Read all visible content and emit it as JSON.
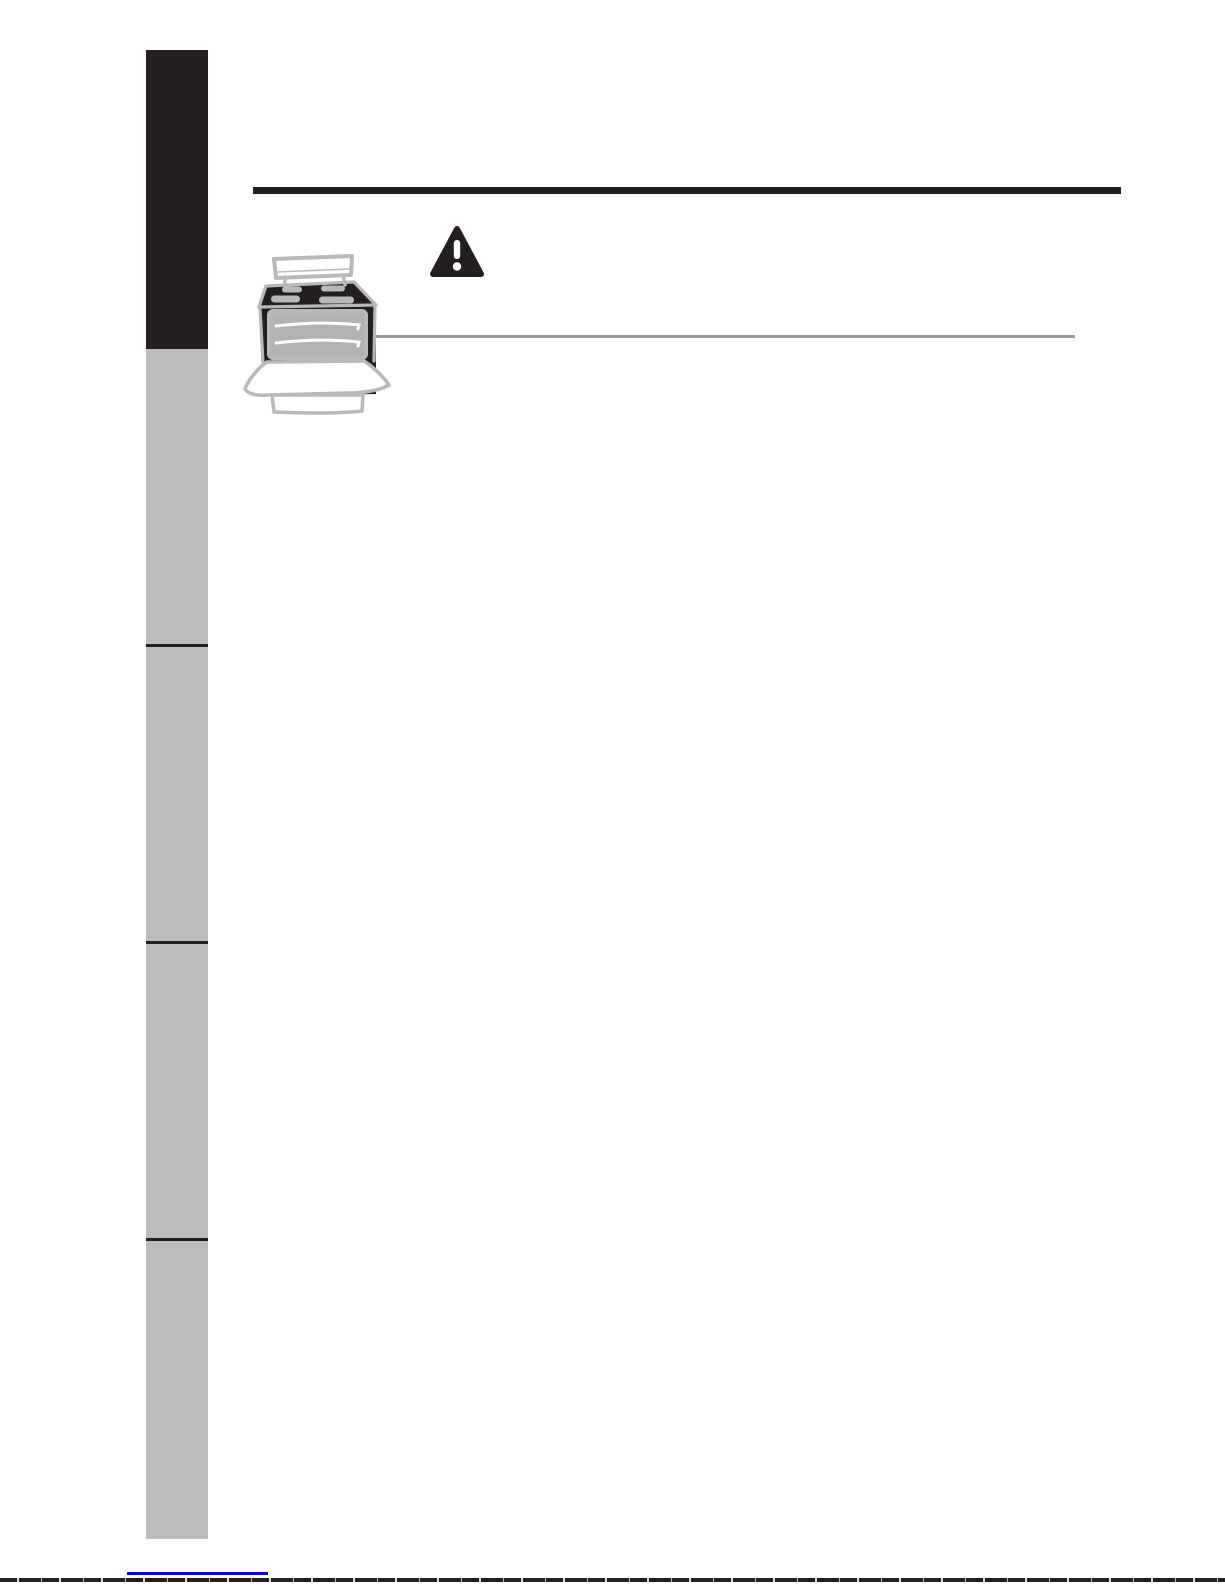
{
  "page": {
    "background": "#ffffff"
  },
  "colors": {
    "ink": "#231f20",
    "tab_gray": "#bcbcbc",
    "sketch_gray": "#b9b9b9",
    "cavity_gray": "#b3b3b3",
    "hairline_gray": "#9a9a9c",
    "link_blue": "#0600d8"
  },
  "sidebar": {
    "segments": [
      {
        "tone": "dark"
      },
      {
        "tone": "gray"
      },
      {
        "tone": "gray"
      },
      {
        "tone": "gray"
      },
      {
        "tone": "gray"
      }
    ]
  },
  "icons": {
    "warning": "warning-triangle-icon",
    "illustration": "open-door-range-sketch"
  }
}
